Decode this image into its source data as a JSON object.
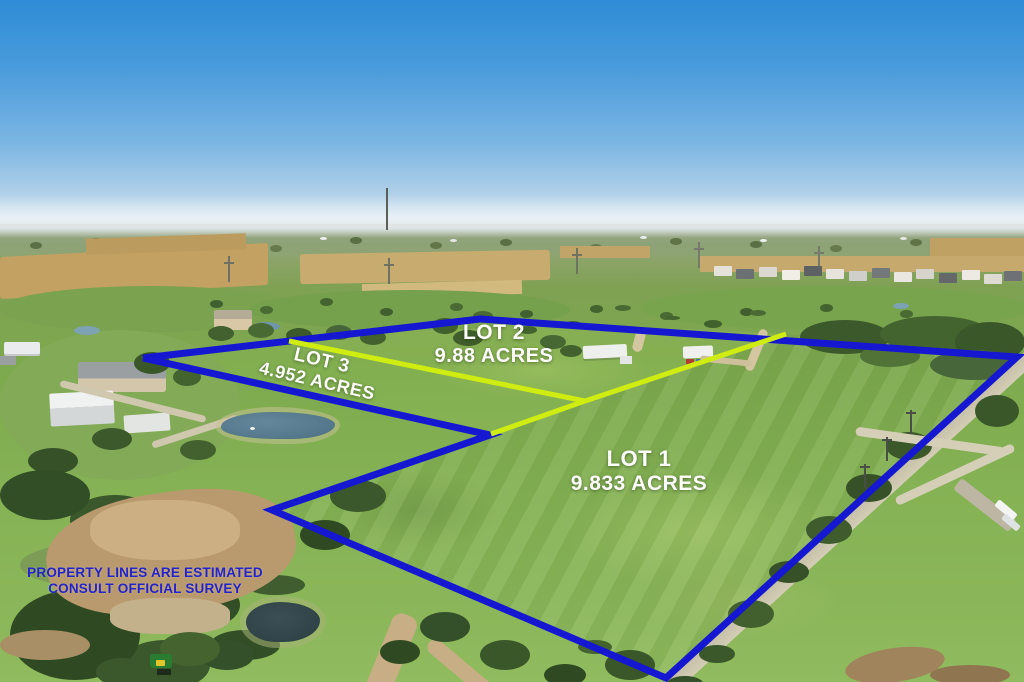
{
  "colors": {
    "boundary_blue": "#1518d0",
    "divider_yellow": "#d0ed12",
    "lot_label_text": "#ffffff",
    "disclaimer_text": "#2323c9"
  },
  "lots": {
    "lot1": {
      "name": "LOT 1",
      "acreage": "9.833 ACRES"
    },
    "lot2": {
      "name": "LOT 2",
      "acreage": "9.88 ACRES"
    },
    "lot3": {
      "name": "LOT 3",
      "acreage": "4.952 ACRES"
    }
  },
  "disclaimer": {
    "line1": "PROPERTY LINES ARE ESTIMATED",
    "line2": "CONSULT OFFICIAL SURVEY"
  },
  "boundaries": [
    {
      "name": "outer-boundary-line",
      "color": "boundary_blue",
      "stroke_width": 7,
      "points": [
        [
          143,
          358
        ],
        [
          480,
          319
        ],
        [
          1017,
          357
        ],
        [
          666,
          678
        ],
        [
          272,
          510
        ],
        [
          490,
          435
        ],
        [
          143,
          358
        ]
      ]
    },
    {
      "name": "lot2-lot3-divider-line",
      "color": "divider_yellow",
      "stroke_width": 5,
      "points": [
        [
          289,
          341
        ],
        [
          585,
          401
        ]
      ]
    },
    {
      "name": "lot1-lot3-divider-line",
      "color": "divider_yellow",
      "stroke_width": 5,
      "points": [
        [
          585,
          401
        ],
        [
          491,
          434
        ]
      ]
    },
    {
      "name": "lot1-lot2-divider-line",
      "color": "divider_yellow",
      "stroke_width": 5,
      "points": [
        [
          585,
          401
        ],
        [
          786,
          334
        ]
      ]
    }
  ]
}
